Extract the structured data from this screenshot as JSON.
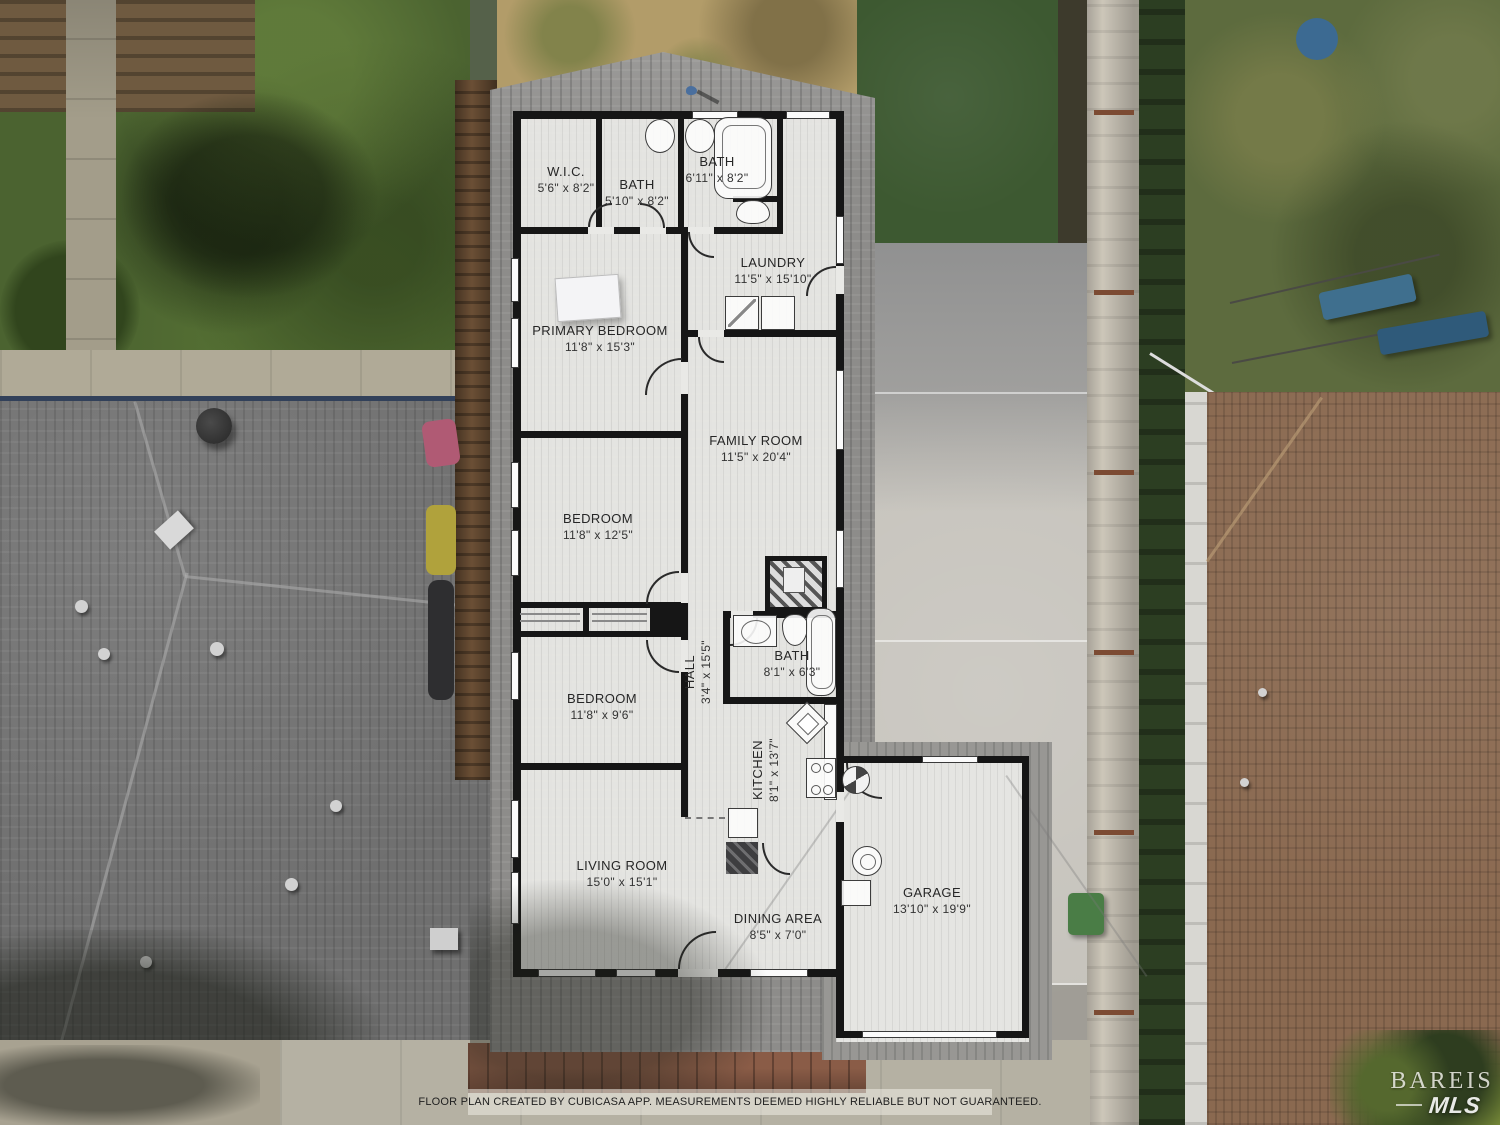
{
  "scene": {
    "description": "Aerial drone view of single-story home with CubiCasa floor plan overlay"
  },
  "floor_plan": {
    "rooms": {
      "wic": {
        "name": "W.I.C.",
        "dims": "5'6\" x 8'2\""
      },
      "bath_top": {
        "name": "BATH",
        "dims": "5'10\" x 8'2\""
      },
      "bath_upper_right": {
        "name": "BATH",
        "dims": "6'11\" x 8'2\""
      },
      "laundry": {
        "name": "LAUNDRY",
        "dims": "11'5\" x 15'10\""
      },
      "primary_bedroom": {
        "name": "PRIMARY BEDROOM",
        "dims": "11'8\" x 15'3\""
      },
      "family_room": {
        "name": "FAMILY ROOM",
        "dims": "11'5\" x 20'4\""
      },
      "bedroom_mid": {
        "name": "BEDROOM",
        "dims": "11'8\" x 12'5\""
      },
      "bedroom_lower": {
        "name": "BEDROOM",
        "dims": "11'8\" x 9'6\""
      },
      "hall": {
        "name": "HALL",
        "dims": "3'4\" x 15'5\""
      },
      "bath_hall": {
        "name": "BATH",
        "dims": "8'1\" x 6'3\""
      },
      "kitchen": {
        "name": "KITCHEN",
        "dims": "8'1\" x 13'7\""
      },
      "living_room": {
        "name": "LIVING ROOM",
        "dims": "15'0\" x 15'1\""
      },
      "dining_area": {
        "name": "DINING AREA",
        "dims": "8'5\" x 7'0\""
      },
      "garage": {
        "name": "GARAGE",
        "dims": "13'10\" x 19'9\""
      }
    }
  },
  "footer": {
    "disclaimer": "FLOOR PLAN CREATED BY CUBICASA APP. MEASUREMENTS DEEMED HIGHLY RELIABLE BUT NOT GUARANTEED."
  },
  "watermark": {
    "line1": "BAREIS",
    "line2": "MLS"
  },
  "colors": {
    "plan_fill": "#e9e9e6",
    "wall": "#161616",
    "subject_roof": "#8d8c8a",
    "left_roof": "#6f6f6f",
    "right_roof": "#8a6950",
    "driveway": "#c6c3bc",
    "lawn": "#4b6330",
    "turf": "#3d5931",
    "fence_right": "#ccc6b9",
    "fence_left": "#6b4f35",
    "brick": "#8a5c47"
  }
}
